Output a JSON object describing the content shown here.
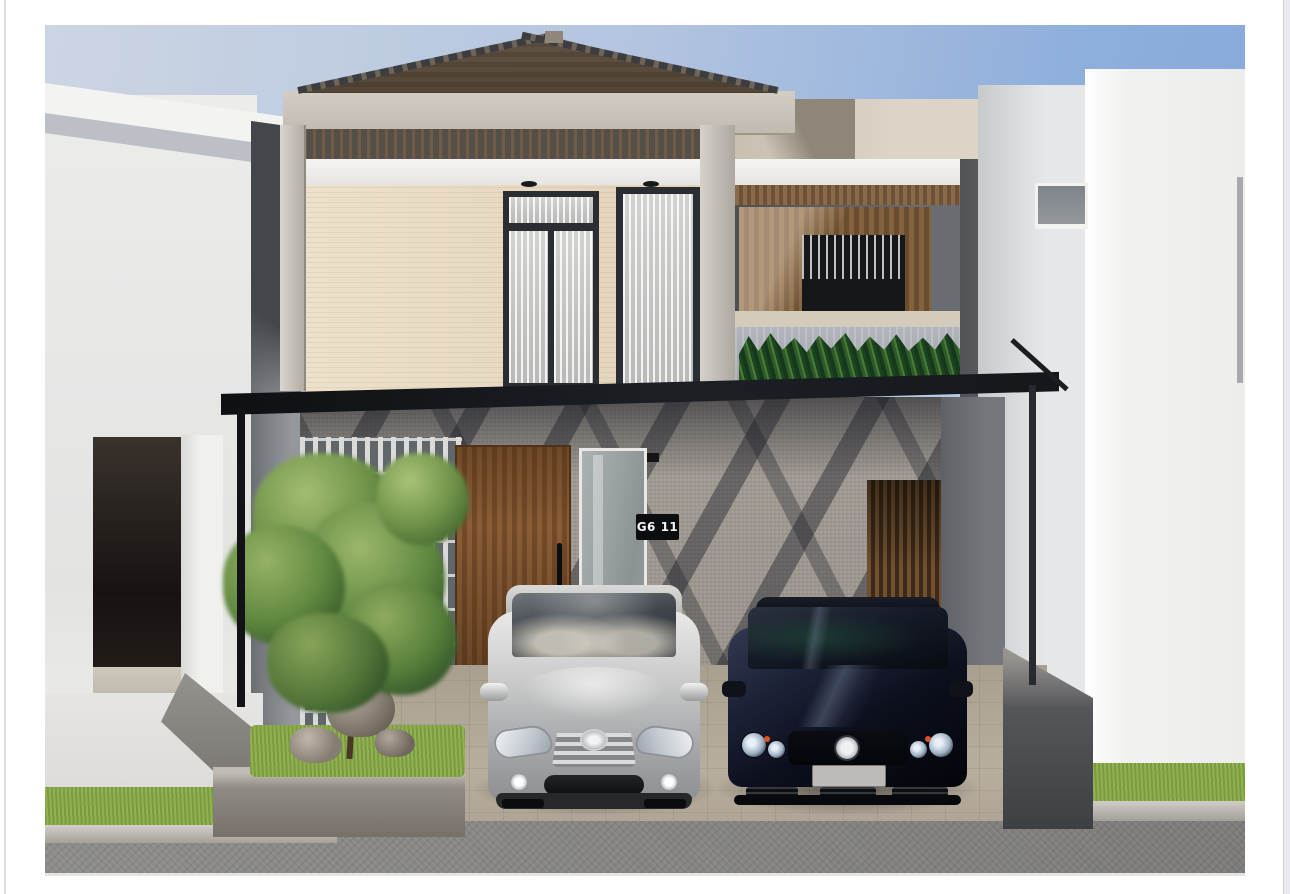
{
  "scene": {
    "type": "3d-architectural-exterior-render",
    "description": "Daytime front-elevation render of a modern two-storey house with a black flat carport canopy, cream upper floor with black-framed curtained windows, hip roof, white lattice garden screen with a tree and rocks, wooden entry door, and two cars parked in the carport, flanked by white neighbouring houses.",
    "house_number_sign": "G6 11"
  },
  "palette": {
    "sky_top_right": "#86a8da",
    "sky_top_left": "#ccd5e3",
    "roof_tile": "#8f8273",
    "upper_wall_cream": "#e7dbc3",
    "window_frame": "#2a2d31",
    "canopy_black": "#16181c",
    "ground_floor_wall": "#9d978f",
    "door_wood": "#82562f",
    "balcony_wood": "#7a5a3a",
    "lattice_white": "#dadbd9",
    "plant_green": "#2e5a29",
    "grass": "#86a548",
    "driveway_paver": "#b2a898",
    "street_gray": "#8c8b89",
    "neighbor_white": "#f1f1f0",
    "car_silver": "#b9babc",
    "car_black_navy": "#0b0e16"
  },
  "objects": [
    "left-neighbor-house",
    "main-house",
    "right-neighbor-house",
    "hip-roof",
    "eave-slab",
    "upper-floor-window-left",
    "upper-floor-window-right",
    "balcony-wood-slat-wall",
    "balcony-louver-window",
    "balcony-planter-plants",
    "carport-canopy",
    "canopy-posts",
    "white-lattice-screen",
    "garden-tree",
    "garden-rocks",
    "wooden-entry-door",
    "door-handle",
    "glass-sidelight",
    "house-number-sign",
    "wood-slat-screen",
    "silver-hatchback-car",
    "black-sedan-car",
    "paved-driveway",
    "grass-verge",
    "street-curb",
    "street"
  ]
}
